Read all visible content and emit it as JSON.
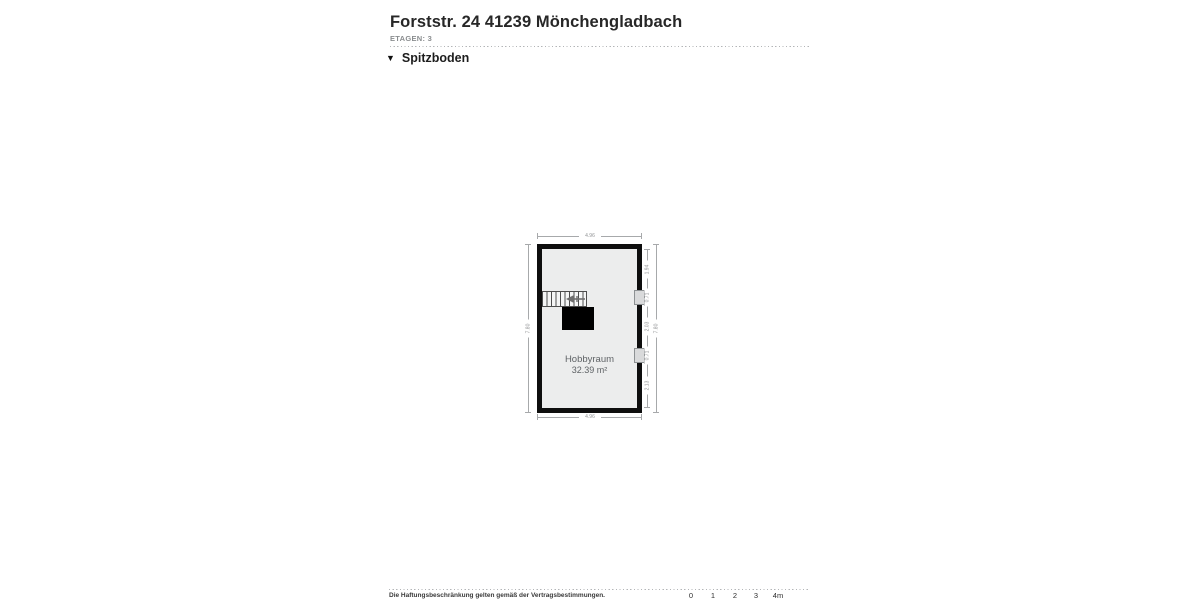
{
  "header": {
    "title": "Forststr. 24 41239 Mönchengladbach",
    "floors_label": "ETAGEN: 3",
    "section": {
      "label": "Spitzboden",
      "icon": "triangle-down-icon",
      "icon_glyph": "▼"
    }
  },
  "floorplan": {
    "room": {
      "name": "Hobbyraum",
      "area": "32.39 m²"
    },
    "dimensions": {
      "top": "4.96",
      "bottom": "4.96",
      "left": "7.80",
      "right_total": "7.80",
      "right_segments": [
        "1.94",
        "0.71",
        "2.03",
        "0.71",
        "2.13"
      ]
    }
  },
  "footer": {
    "disclaimer": "Die Haftungsbeschränkung gelten gemäß der Vertragsbestimmungen.",
    "scale_ticks": [
      "0",
      "1",
      "2",
      "3",
      "4m"
    ]
  },
  "colors": {
    "wall": "#0e0e0e",
    "floor": "#eceded",
    "dimension_line": "#a7a9ab",
    "room_text": "#5f6366",
    "muted_text": "#8a8d8f"
  }
}
